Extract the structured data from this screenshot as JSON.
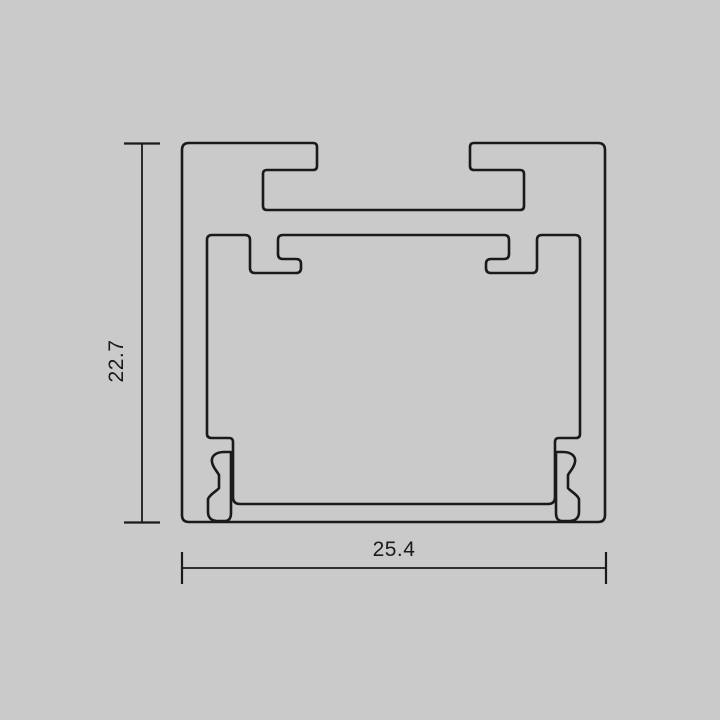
{
  "title": "Aluminium LED profile cross-section drawing",
  "colors": {
    "background": "#cacaca",
    "line": "#1a1a1a"
  },
  "dimensions": {
    "height": {
      "label": "22.7"
    },
    "width": {
      "label": "25.4"
    }
  },
  "drawing": {
    "outer_path": "M 189,143 L 313,143 Q 317,143 317,147 L 317,166 Q 317,170 313,170 L 267,170 Q 263,170 263,174 L 263,206 Q 263,210 267,210 L 520,210 Q 524,210 524,206 L 524,174 Q 524,170 520,170 L 474,170 Q 470,170 470,166 L 470,147 Q 470,143 474,143 L 598,143 Q 605,143 605,150 L 605,515 Q 605,522 598,522 L 189,522 Q 182,522 182,515 L 182,150 Q 182,143 189,143 Z",
    "inner_path": "M 207,240 Q 207,235 212,235 L 245,235 Q 250,235 250,240 L 250,268 Q 250,273 255,273 L 296,273 Q 301,273 301,268 L 301,264 Q 301,259 296,259 L 283,259 Q 278,259 278,254 L 278,240 Q 278,235 283,235 L 504,235 Q 509,235 509,240 L 509,254 Q 509,259 504,259 L 491,259 Q 486,259 486,264 L 486,268 Q 486,273 491,273 L 532,273 Q 537,273 537,268 L 537,240 Q 537,235 542,235 L 575,235 Q 580,235 580,240 L 580,434 Q 580,438 576,438 L 559,438 Q 555,438 555,442 L 555,497 Q 555,504 548,504 L 240,504 Q 233,504 233,497 L 233,442 Q 233,438 229,438 L 212,438 Q 207,438 207,434 L 207,240 Z",
    "screw_channel_left_path": "M 231,452 L 224,452 C 216,452 211,456 212,462 C 213,468 217,471 219,475 L 219,488 C 217,491 210,494 208,499 L 208,512 C 208,518 212,521 217,521 L 225,521 C 229,521 231,518 231,513 Z",
    "screw_channel_right_path": "M 556,452 L 563,452 C 571,452 576,456 575,462 C 574,468 570,471 568,475 L 568,488 C 570,491 577,494 579,499 L 579,512 C 579,518 575,521 570,521 L 562,521 C 558,521 556,518 556,513 Z",
    "height_dim": {
      "line": {
        "x1": 142,
        "y1": 144,
        "x2": 142,
        "y2": 522
      },
      "tick_top": {
        "x1": 124,
        "y1": 143.5,
        "x2": 160,
        "y2": 143.5
      },
      "tick_bottom": {
        "x1": 124,
        "y1": 522.5,
        "x2": 160,
        "y2": 522.5
      },
      "label_x": -331,
      "label_y": 123
    },
    "width_dim": {
      "line": {
        "x1": 182,
        "y1": 568,
        "x2": 606,
        "y2": 568
      },
      "tick_left": {
        "x1": 182,
        "y1": 552,
        "x2": 182,
        "y2": 584
      },
      "tick_right": {
        "x1": 606,
        "y1": 552,
        "x2": 606,
        "y2": 584
      },
      "label_x": 394,
      "label_y": 556
    }
  }
}
